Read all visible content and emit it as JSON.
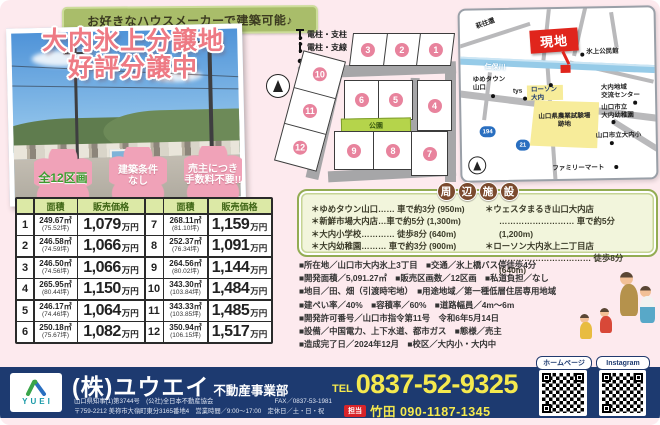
{
  "banner": {
    "text": "お好きなハウスメーカーで建築可能♪"
  },
  "title": {
    "line1": "大内氷上分譲地",
    "line2": "好評分譲中"
  },
  "badges": {
    "b1": "全12区画",
    "b2": "建築条件\nなし",
    "b3": "売主につき\n手数料不要!!"
  },
  "price_table": {
    "header_area": "面積",
    "header_price": "販売価格",
    "unit": "万円",
    "rows": [
      {
        "no": "1",
        "area": "249.67㎡",
        "tsubo": "(75.52坪)",
        "price": "1,079"
      },
      {
        "no": "2",
        "area": "246.58㎡",
        "tsubo": "(74.59坪)",
        "price": "1,066"
      },
      {
        "no": "3",
        "area": "246.50㎡",
        "tsubo": "(74.56坪)",
        "price": "1,066"
      },
      {
        "no": "4",
        "area": "265.95㎡",
        "tsubo": "(80.44坪)",
        "price": "1,150"
      },
      {
        "no": "5",
        "area": "246.17㎡",
        "tsubo": "(74.46坪)",
        "price": "1,064"
      },
      {
        "no": "6",
        "area": "250.18㎡",
        "tsubo": "(75.67坪)",
        "price": "1,082"
      },
      {
        "no": "7",
        "area": "268.11㎡",
        "tsubo": "(81.10坪)",
        "price": "1,159"
      },
      {
        "no": "8",
        "area": "252.37㎡",
        "tsubo": "(76.34坪)",
        "price": "1,091"
      },
      {
        "no": "9",
        "area": "264.56㎡",
        "tsubo": "(80.02坪)",
        "price": "1,144"
      },
      {
        "no": "10",
        "area": "343.30㎡",
        "tsubo": "(103.84坪)",
        "price": "1,484"
      },
      {
        "no": "11",
        "area": "343.33㎡",
        "tsubo": "(103.85坪)",
        "price": "1,485"
      },
      {
        "no": "12",
        "area": "350.94㎡",
        "tsubo": "(106.15坪)",
        "price": "1,517"
      }
    ]
  },
  "lot_map": {
    "legend": [
      "電柱・支柱",
      "電柱・支線",
      "電柱"
    ],
    "park": "公園",
    "lots": [
      "1",
      "2",
      "3",
      "4",
      "5",
      "6",
      "7",
      "8",
      "9",
      "10",
      "11",
      "12"
    ]
  },
  "area_map": {
    "site": "現地",
    "river": "仁保川",
    "hagi_road": "萩往還",
    "hikami_hall": "氷上公民館",
    "yumetown": "ゆめタウン\n山口",
    "tys": "tys",
    "lawson": "ローソン\n大内",
    "exchange_center": "大内地域\n交流センター",
    "kindergarten": "山口市立\n大内幼稚園",
    "farm_site": "山口県農業試験場\n跡地",
    "elementary": "山口市立大内小",
    "familymart": "ファミリーマート",
    "route_a": "194",
    "route_b": "21"
  },
  "facilities": {
    "title_chars": [
      "周",
      "辺",
      "施",
      "設"
    ],
    "left": [
      "＊ゆめタウン山口…… 車で約3分 (950m)",
      "＊新鮮市場大内店…車で約5分 (1,300m)",
      "＊大内小学校………… 徒歩8分 (640m)",
      "＊大内幼稚園……… 車で約3分 (900m)"
    ],
    "right": [
      "＊ウェスタまるき山口大内店",
      "……………………… 車で約5分 (1,200m)",
      "＊ローソン大内氷上二丁目店",
      "…………………………… 徒歩8分 (640m)"
    ]
  },
  "details": [
    "■所在地／山口市大内氷上3丁目　■交通／氷上橋バス停徒歩4分",
    "■開発面積／5,091.27㎡　■販売区画数／12区画　■私道負担／なし",
    "■地目／田、畑（引渡時宅地）　■用途地域／第一種低層住居専用地域",
    "■建ぺい率／40%　■容積率／60%　■道路幅員／4m～6m",
    "■開発許可番号／山口市指令第11号　令和6年5月14日",
    "■設備／中国電力、上下水道、都市ガス　■態様／売主",
    "■造成完了日／2024年12月　■校区／大内小・大内中"
  ],
  "footer": {
    "logo_text": "YUEI",
    "company": "(株)ユウエイ",
    "dept": "不動産事業部",
    "license": "山口県知事(1)第3744号　(公社)全日本不動産協会",
    "fax": "FAX／0837-53-1981",
    "address": "〒759-2212 美祢市大嶺町東分3165番地4　営業時間／9:00～17:00　定休日／土・日・祝",
    "tel_label": "TEL",
    "tel": "0837-52-9325",
    "contact_label": "担当",
    "contact": "竹田 090-1187-1345",
    "qr1_label": "ホームページ",
    "qr2_label": "Instagram"
  }
}
